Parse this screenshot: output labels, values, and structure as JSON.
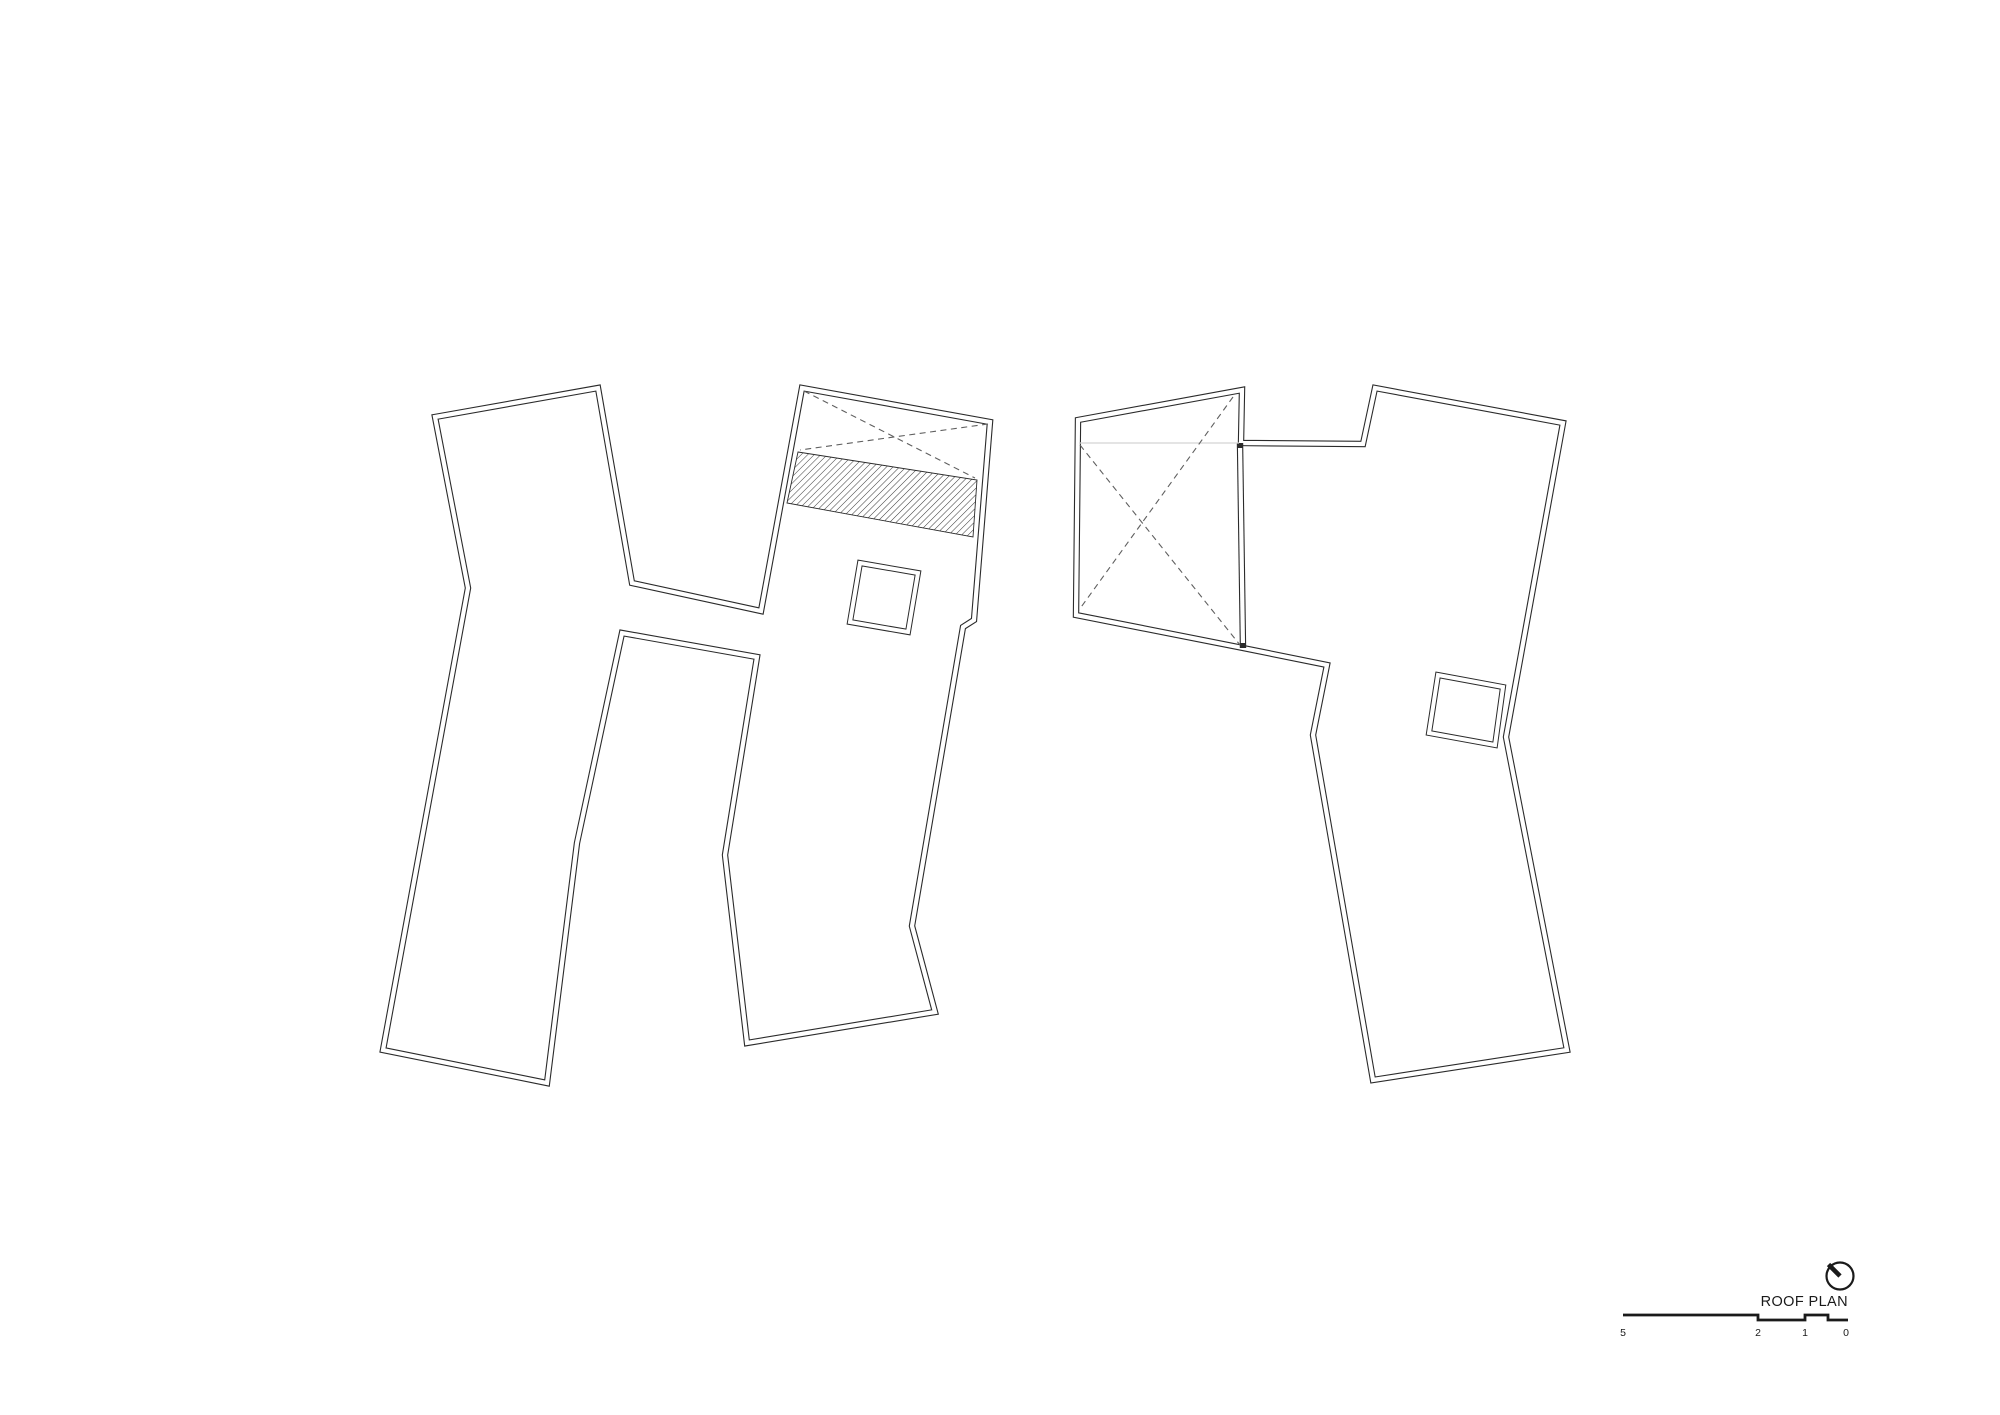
{
  "page": {
    "background": "#ffffff"
  },
  "colors": {
    "line": "#2b2b2b",
    "gap": "#ffffff",
    "dash": "#5f5f5f",
    "faint": "#d4d4d4",
    "hatch_line": "#383838",
    "text": "#1a1a1a"
  },
  "title_block": {
    "title": "ROOF PLAN",
    "north_arrow": {
      "icon": "north-arrow-icon",
      "center": [
        1840,
        1276
      ],
      "radius": 13.5,
      "needle_end": [
        1828.5,
        1264.5
      ]
    }
  },
  "scale_bar": {
    "labels": [
      "5",
      "2",
      "1",
      "0"
    ],
    "label_xs": [
      1623,
      1758,
      1805,
      1846
    ],
    "label_y": 1336,
    "y_high": 1315,
    "y_low": 1320,
    "steps": [
      {
        "x1": 1623,
        "x2": 1758,
        "level": "high"
      },
      {
        "x1": 1758,
        "x2": 1805,
        "level": "low"
      },
      {
        "x1": 1805,
        "x2": 1828,
        "level": "high"
      },
      {
        "x1": 1828,
        "x2": 1848,
        "level": "low"
      }
    ]
  },
  "drawing": {
    "buildings": [
      {
        "name": "building-west",
        "outline": [
          [
            435,
            417
          ],
          [
            598,
            388
          ],
          [
            632,
            583
          ],
          [
            761,
            611
          ],
          [
            802,
            388
          ],
          [
            990,
            422
          ],
          [
            974,
            620
          ],
          [
            963,
            627
          ],
          [
            912,
            926
          ],
          [
            935,
            1012
          ],
          [
            747,
            1043
          ],
          [
            725,
            855
          ],
          [
            757,
            657
          ],
          [
            622,
            633
          ],
          [
            577,
            843
          ],
          [
            547,
            1083
          ],
          [
            383,
            1050
          ],
          [
            468,
            588
          ]
        ],
        "x_skylight_diagonals": [
          [
            [
              804,
              391
            ],
            [
              975,
              478
            ]
          ],
          [
            [
              988,
              424
            ],
            [
              800,
              450
            ]
          ]
        ],
        "hatch_band": [
          [
            798,
            452
          ],
          [
            977,
            480
          ],
          [
            973,
            537
          ],
          [
            787,
            503
          ]
        ],
        "skylights": [
          [
            [
              860,
              563
            ],
            [
              918,
              573
            ],
            [
              908,
              632
            ],
            [
              850,
              622
            ]
          ]
        ]
      },
      {
        "name": "building-east",
        "outline": [
          [
            1078,
            420
          ],
          [
            1242,
            390
          ],
          [
            1241,
            443
          ],
          [
            1363,
            444
          ],
          [
            1375,
            388
          ],
          [
            1563,
            423
          ],
          [
            1506,
            737
          ],
          [
            1567,
            1050
          ],
          [
            1373,
            1080
          ],
          [
            1313,
            735
          ],
          [
            1327,
            665
          ],
          [
            1243,
            648
          ],
          [
            1076,
            615
          ]
        ],
        "interior_lines": [
          [
            [
              1240,
              443
            ],
            [
              1243,
              648
            ]
          ]
        ],
        "hidden_lines": [
          [
            [
              1079,
              443
            ],
            [
              1239,
              443
            ]
          ]
        ],
        "x_skylight_diagonals": [
          [
            [
              1080,
              445
            ],
            [
              1240,
              645
            ]
          ],
          [
            [
              1233,
              397
            ],
            [
              1079,
              610
            ]
          ]
        ],
        "skylights": [
          [
            [
              1438,
              675
            ],
            [
              1503,
              687
            ],
            [
              1495,
              745
            ],
            [
              1429,
              733
            ]
          ]
        ]
      }
    ]
  }
}
